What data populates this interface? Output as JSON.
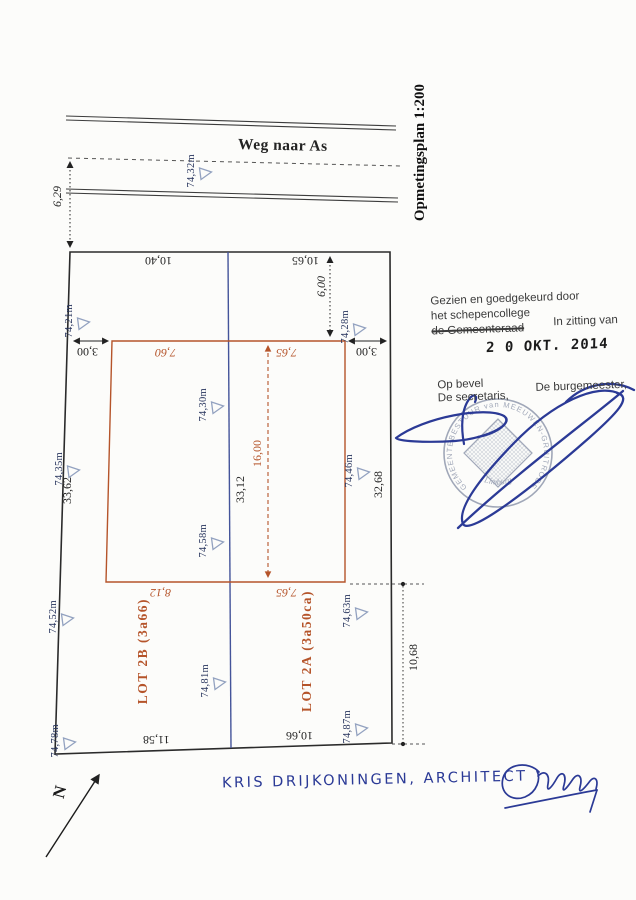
{
  "document": {
    "scale_title": "Opmetingsplan 1:200",
    "north_label": "N",
    "road": {
      "name": "Weg naar As",
      "centerline_elevation": "74,32m",
      "offset_to_plot": "6,29"
    },
    "lots": {
      "lot_2b": "LOT 2B (3a66)",
      "lot_2a": "LOT 2A (3a50ca)"
    },
    "dims": {
      "front_left": "10,40",
      "front_right": "10,65",
      "build_depth_offset": "6,00",
      "setback_left": "3,00",
      "setback_right": "3,00",
      "zone_top_left": "7,60",
      "zone_top_right": "7,65",
      "zone_depth": "16,00",
      "zone_bottom_left": "8,12",
      "zone_bottom_right": "7,65",
      "side_left": "33,62",
      "side_middle": "33,12",
      "side_right": "32,68",
      "rear_left": "11,58",
      "rear_right": "10,66",
      "right_rear_offset": "10,68"
    },
    "elevations": [
      "74,21m",
      "74,28m",
      "74,30m",
      "74,35m",
      "74,46m",
      "74,58m",
      "74,52m",
      "74,63m",
      "74,81m",
      "74,78m",
      "74,87m"
    ]
  },
  "approval": {
    "line1": "Gezien en goedgekeurd door",
    "line2": "het schepencollege",
    "line3_struck": "de Gemeenteraad",
    "session_label": "In zitting van",
    "date_stamp": "2 0 OKT. 2014",
    "order_label": "Op bevel",
    "secretary_label": "De secretaris,",
    "mayor_label": "De burgemeester,"
  },
  "stamp": {
    "ring_text": "GEMEENTEBESTUUR van MEEUWEN-GRUITRODE",
    "province": "Limburg"
  },
  "footer": {
    "architect_line": "KRIS DRIJKONINGEN, ARCHITECT"
  },
  "colors": {
    "ink_blue": "#2b3a96",
    "plan_orange": "#b5542a",
    "divider_blue": "#44549a",
    "elevation_navy": "#26335c",
    "stamp_gray": "#8a93a8"
  }
}
